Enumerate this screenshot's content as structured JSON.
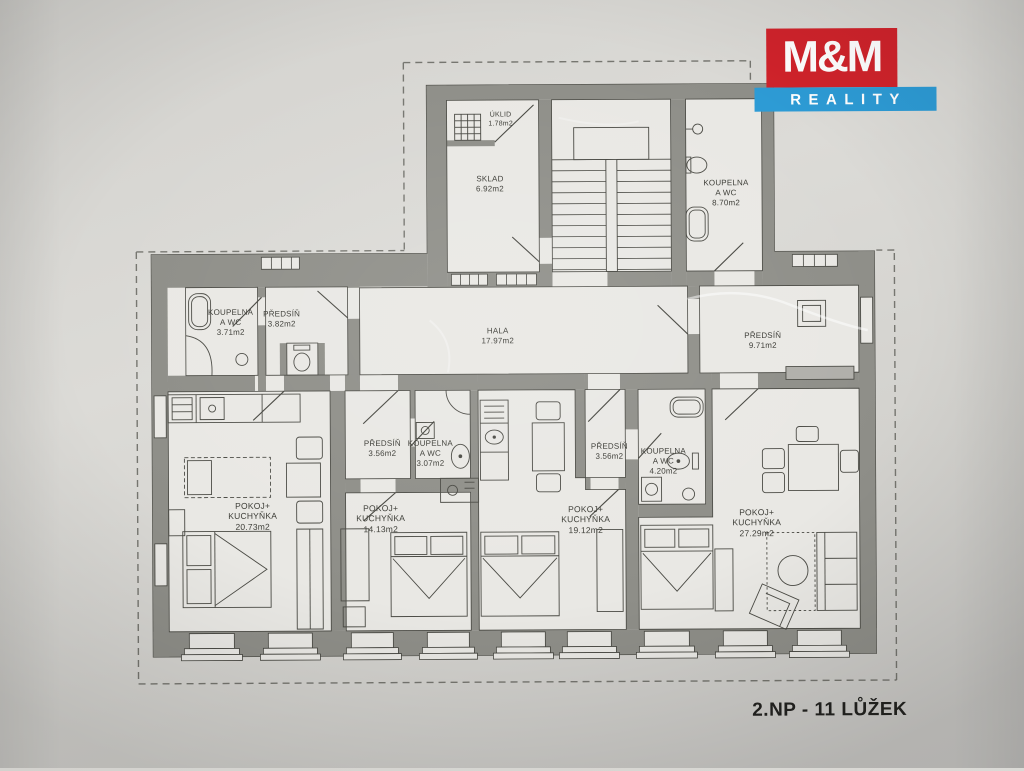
{
  "logo": {
    "line1": "M&M",
    "line2": "REALITY",
    "red": "#d0232b",
    "blue": "#2d9bd5"
  },
  "caption": "2.NP - 11 LŮŽEK",
  "rooms": [
    {
      "id": "uklid",
      "line1": "ÚKLID",
      "line2": "",
      "area": "1.78m2"
    },
    {
      "id": "sklad",
      "line1": "SKLAD",
      "line2": "",
      "area": "6.92m2"
    },
    {
      "id": "koupelna-870",
      "line1": "KOUPELNA",
      "line2": "A WC",
      "area": "8.70m2"
    },
    {
      "id": "koupelna-371",
      "line1": "KOUPELNA",
      "line2": "A WC",
      "area": "3.71m2"
    },
    {
      "id": "predsin-382",
      "line1": "PŘEDSÍŇ",
      "line2": "",
      "area": "3.82m2"
    },
    {
      "id": "hala",
      "line1": "HALA",
      "line2": "",
      "area": "17.97m2"
    },
    {
      "id": "predsin-971",
      "line1": "PŘEDSÍŇ",
      "line2": "",
      "area": "9.71m2"
    },
    {
      "id": "predsin-356-l",
      "line1": "PŘEDSÍŇ",
      "line2": "",
      "area": "3.56m2"
    },
    {
      "id": "koupelna-307",
      "line1": "KOUPELNA",
      "line2": "A WC",
      "area": "3.07m2"
    },
    {
      "id": "predsin-356-r",
      "line1": "PŘEDSÍŇ",
      "line2": "",
      "area": "3.56m2"
    },
    {
      "id": "koupelna-420",
      "line1": "KOUPELNA",
      "line2": "A WC",
      "area": "4.20m2"
    },
    {
      "id": "pokoj-2073",
      "line1": "POKOJ+",
      "line2": "KUCHYŇKA",
      "area": "20.73m2"
    },
    {
      "id": "pokoj-1413",
      "line1": "POKOJ+",
      "line2": "KUCHYŇKA",
      "area": "14.13m2"
    },
    {
      "id": "pokoj-1912",
      "line1": "POKOJ+",
      "line2": "KUCHYŇKA",
      "area": "19.12m2"
    },
    {
      "id": "pokoj-2729",
      "line1": "POKOJ+",
      "line2": "KUCHYŇKA",
      "area": "27.29m2"
    }
  ]
}
